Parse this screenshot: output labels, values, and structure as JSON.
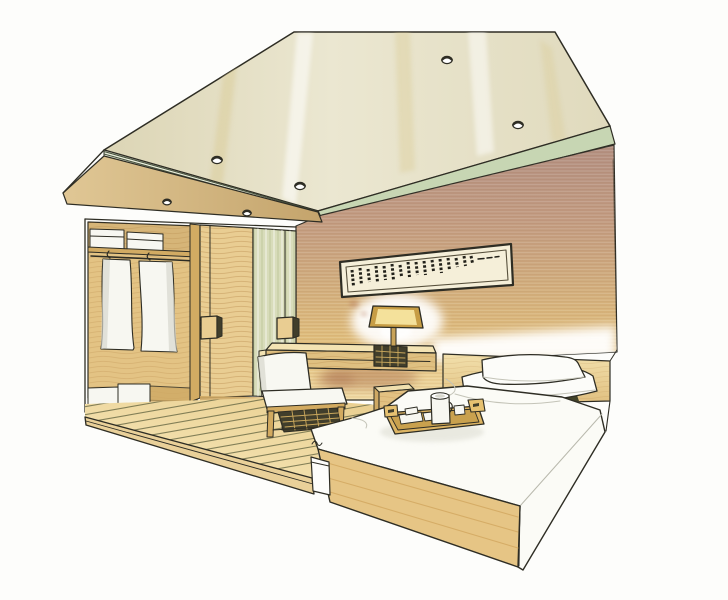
{
  "meta": {
    "description": "hand-drawn marker sketch of a hotel bedroom interior"
  },
  "palette": {
    "paper": "#fdfdfb",
    "ink": "#2e2d24",
    "ceiling_left": "#dcd5b5",
    "ceiling_mid": "#ebe7d1",
    "ceiling_right": "#e0dabd",
    "stripe_band": "#edf0df",
    "cove_line": "#49543f",
    "green_band": "#c7d6b3",
    "wall_top": "#b28f80",
    "wall_upper": "#c29b80",
    "wall_mid": "#d1ad7c",
    "wall_lower": "#e2c07b",
    "wall_glow": "#f2dda6",
    "corner_glass": "#d8dcba",
    "door_wood": "#e9cd92",
    "closet_interior": "#e3c384",
    "closet_shadow": "#cfa964",
    "divider": "#d2ab63",
    "white_goods": "#f7f7f1",
    "robe_shade": "#d7d7cf",
    "floor_light": "#f7e9bc",
    "floor_base": "#ead092",
    "plank_line": "#676844",
    "platform_edge": "#e9d099",
    "desk_top": "#f3e3b3",
    "desk_front": "#dfc081",
    "weave_dark": "#413e2b",
    "weave_tan": "#c9a75c",
    "lamp_shade_rim": "#c79d45",
    "lamp_shade_glow": "#f4e19b",
    "lamp_stem": "#c8a359",
    "chair_frame": "#d2aa60",
    "cushion": "#f8f8f2",
    "cushion_shade": "#dbdbd1",
    "headboard_top": "#f2e0ac",
    "headboard": "#e0bf7f",
    "bed_white": "#fbfbf6",
    "bed_shade": "#e8e7df",
    "bed_base": "#e6c585",
    "base_grain": "#d2a75f",
    "nightstand": "#e2c182",
    "nightstand_top": "#f0dfae",
    "tray": "#dcb463",
    "tray_inner": "#c9a14e",
    "tray_rim": "#e6c171",
    "pillow": "#fcfcf9",
    "art_mat": "#f5efd9",
    "art_frame": "#57503c",
    "glyph": "#22211a"
  },
  "lighting": {
    "ceiling_downlights": [
      [
        217,
        160
      ],
      [
        300,
        186
      ],
      [
        447,
        60
      ],
      [
        518,
        125
      ]
    ],
    "soffit_downlights": [
      [
        167,
        202
      ],
      [
        247,
        213
      ]
    ]
  },
  "floor": {
    "plank_lines": 16
  },
  "artwork": {
    "marks": [
      [
        352,
        270,
        16
      ],
      [
        360,
        268,
        17
      ],
      [
        368,
        269,
        13
      ],
      [
        376,
        266,
        16
      ],
      [
        384,
        266,
        14
      ],
      [
        392,
        264,
        16
      ],
      [
        400,
        265,
        11
      ],
      [
        408,
        262,
        15
      ],
      [
        416,
        262,
        13
      ],
      [
        424,
        261,
        14
      ],
      [
        432,
        260,
        11
      ],
      [
        440,
        259,
        14
      ],
      [
        448,
        258,
        12
      ],
      [
        456,
        258,
        9
      ],
      [
        464,
        256,
        10
      ],
      [
        471,
        256,
        7
      ]
    ],
    "dashes": [
      [
        478,
        259,
        6
      ],
      [
        487,
        258,
        5
      ],
      [
        495,
        257,
        4
      ]
    ]
  }
}
